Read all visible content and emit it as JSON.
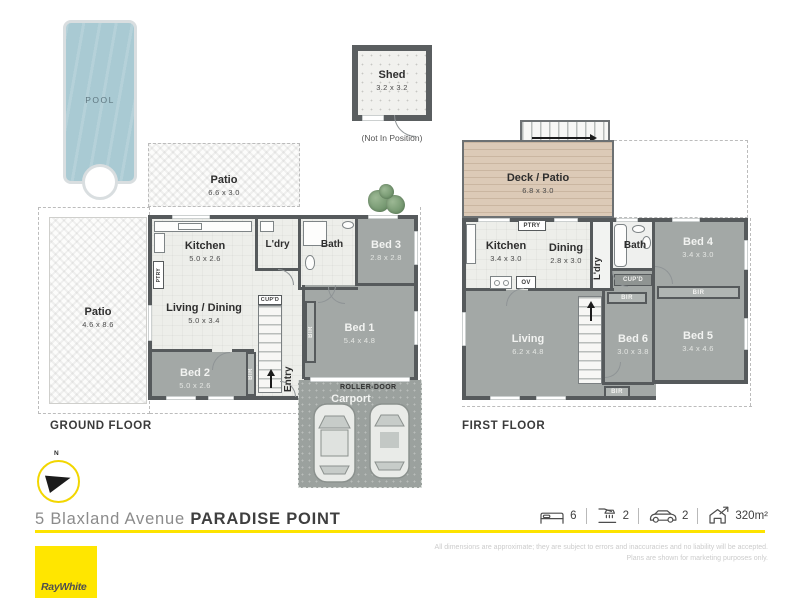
{
  "pool": {
    "label": "POOL"
  },
  "shed": {
    "name": "Shed",
    "dims": "3.2 x 3.2",
    "note": "(Not In Position)"
  },
  "ground": {
    "title": "GROUND FLOOR",
    "patio_top": {
      "name": "Patio",
      "dims": "6.6 x 3.0"
    },
    "patio_left": {
      "name": "Patio",
      "dims": "4.6 x 8.6"
    },
    "kitchen": {
      "name": "Kitchen",
      "dims": "5.0 x 2.6"
    },
    "ldry": {
      "name": "L'dry"
    },
    "bath": {
      "name": "Bath"
    },
    "bed3": {
      "name": "Bed 3",
      "dims": "2.8 x 2.8"
    },
    "living": {
      "name": "Living / Dining",
      "dims": "5.0 x 3.4"
    },
    "bed2": {
      "name": "Bed 2",
      "dims": "5.0 x 2.6"
    },
    "bed1": {
      "name": "Bed 1",
      "dims": "5.4 x 4.8"
    },
    "entry": {
      "name": "Entry"
    },
    "carport": {
      "name": "Carport"
    },
    "roller_door": "ROLLER-DOOR",
    "cupd": "CUP'D",
    "ptry": "PTRY",
    "bir": "BIR"
  },
  "first": {
    "title": "FIRST FLOOR",
    "deck": {
      "name": "Deck / Patio",
      "dims": "6.8 x 3.0"
    },
    "kitchen": {
      "name": "Kitchen",
      "dims": "3.4 x 3.0"
    },
    "dining": {
      "name": "Dining",
      "dims": "2.8 x 3.0"
    },
    "ldry": {
      "name": "L'dry"
    },
    "bath": {
      "name": "Bath"
    },
    "bed4": {
      "name": "Bed 4",
      "dims": "3.4 x 3.0"
    },
    "bed5": {
      "name": "Bed 5",
      "dims": "3.4 x 4.6"
    },
    "bed6": {
      "name": "Bed 6",
      "dims": "3.0 x 3.8"
    },
    "living": {
      "name": "Living",
      "dims": "6.2 x 4.8"
    },
    "ptry": "PTRY",
    "ov": "OV",
    "cupd": "CUP'D",
    "bir": "BIR"
  },
  "compass": {
    "north": "N"
  },
  "footer": {
    "address_street": "5 Blaxland Avenue",
    "address_suburb": "PARADISE POINT",
    "beds": "6",
    "baths": "2",
    "cars": "2",
    "area": "320m²",
    "disclaimer_line1": "All dimensions are approximate; they are subject to errors and inaccuracies and no liability will be accepted.",
    "disclaimer_line2": "Plans are shown for marketing purposes only.",
    "brand": "RayWhite"
  },
  "colors": {
    "brand_yellow": "#ffe600",
    "wall": "#565a5c",
    "room_gray": "#a3a8a6",
    "room_light": "#edeeea",
    "pool_blue": "#a9cad3",
    "deck_tan": "#dccab7"
  }
}
